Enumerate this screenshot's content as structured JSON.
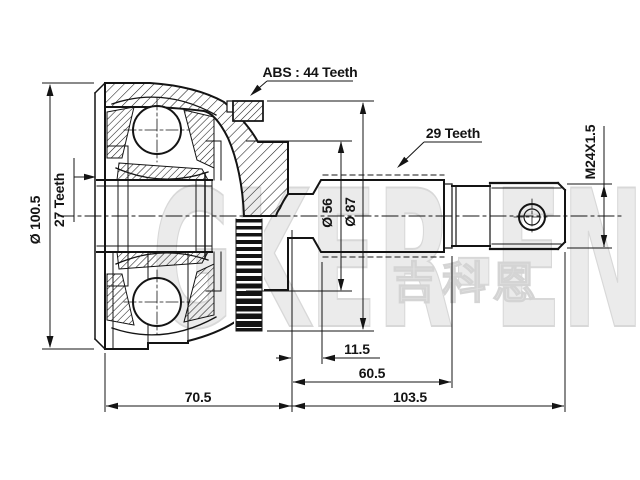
{
  "drawing": {
    "title_hint": "CV joint outer race technical drawing",
    "callouts": {
      "abs": "ABS : 44 Teeth",
      "outer_spline": "29 Teeth",
      "inner_spline": "27 Teeth",
      "thread": "M24X1.5"
    },
    "diameters": {
      "housing": "Ø 100.5",
      "boot_groove": "Ø 56",
      "abs_ring_seat": "Ø 87"
    },
    "lengths": {
      "groove_width": "11.5",
      "spline_section": "60.5",
      "housing": "70.5",
      "shaft": "103.5"
    },
    "watermark": {
      "latin": "GKER-EN",
      "cjk": "吉科恩"
    },
    "colors": {
      "line": "#141414",
      "watermark": "#e6e6e6",
      "background": "#ffffff"
    }
  }
}
